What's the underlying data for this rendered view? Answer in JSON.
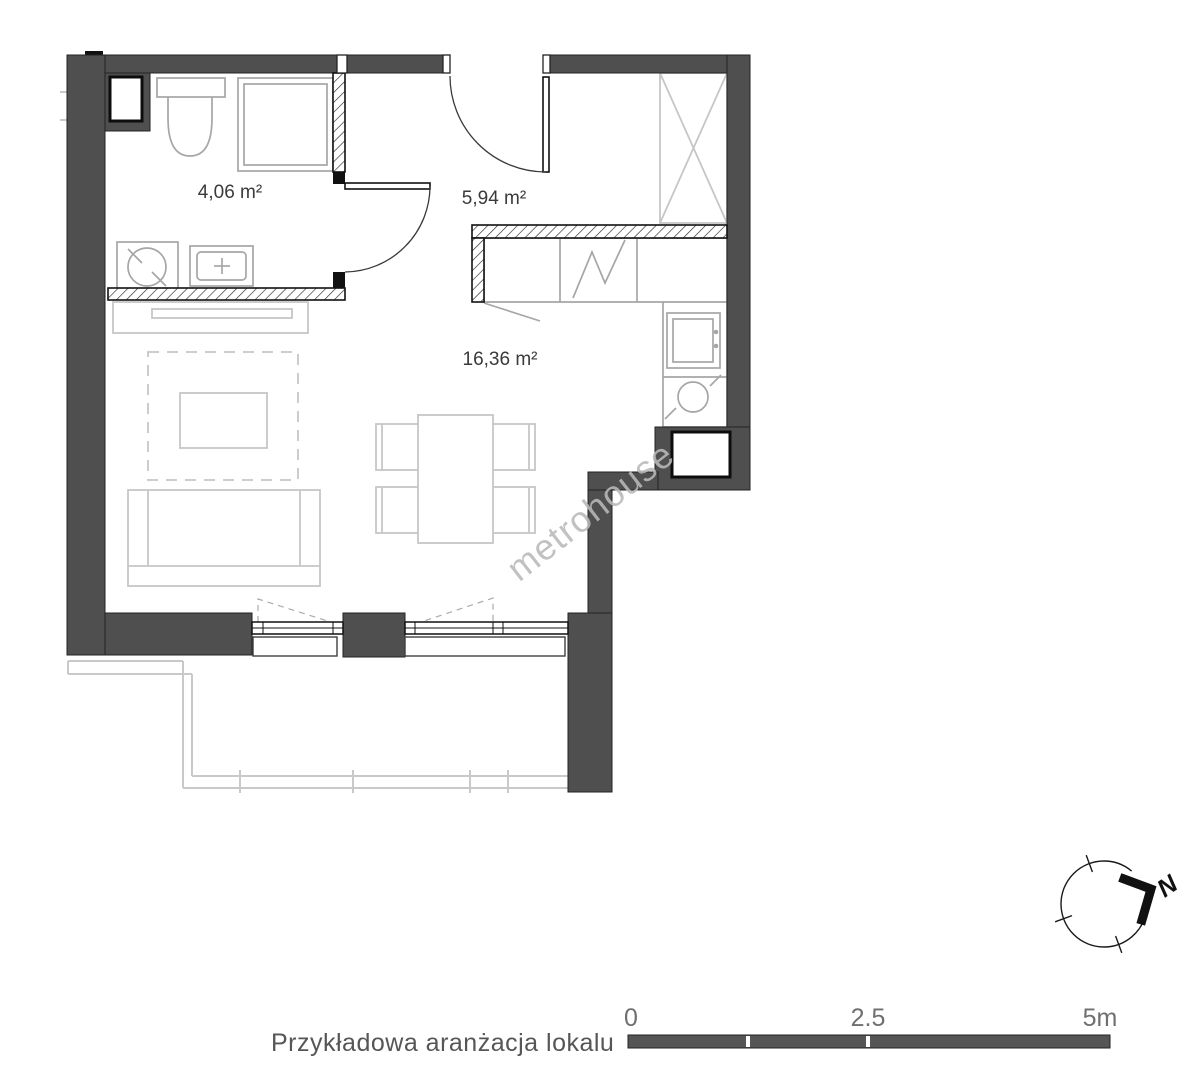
{
  "floor_plan": {
    "rooms": [
      {
        "name": "bathroom",
        "area": "4,06 m²"
      },
      {
        "name": "hallway",
        "area": "5,94 m²"
      },
      {
        "name": "living-room-with-kitchenette",
        "area": "16,36 m²"
      }
    ],
    "watermark": "metrohouse",
    "caption": "Przykładowa aranżacja lokalu",
    "compass": {
      "north_label": "N"
    },
    "scale_bar": {
      "start_label": "0",
      "mid_label": "2.5",
      "end_label": "5m"
    }
  },
  "colors": {
    "wall": "#4f4f4f",
    "wall_outline": "#232323",
    "fixture_gray": "#a6a6a6",
    "furniture_gray": "#c6c6c6",
    "room_label_text": "#3a3a3a",
    "scale_text": "#6f6f6f",
    "caption_text": "#565656",
    "watermark_gray": "#b9b9b9"
  }
}
